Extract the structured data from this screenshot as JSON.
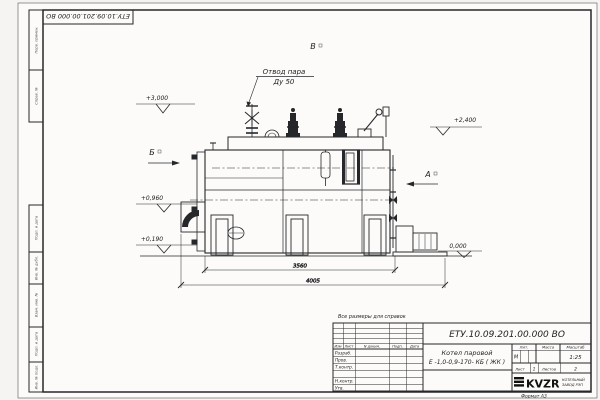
{
  "sheet": {
    "corner_stamp": "ЕТУ.10.09.201.00.000  ВО",
    "format_label": "Формат  А3",
    "note": "Все размеры для справок",
    "margin_labels": [
      "Перв. примен.",
      "Справ. №",
      "Подп. и дата",
      "Инв. № дубл.",
      "Взам. инв. №",
      "Подп. и дата",
      "Инв. № подл."
    ]
  },
  "drawing": {
    "callout": {
      "line1": "Отвод пара",
      "line2": "Ду 50"
    },
    "elevations": {
      "e3000": "+3,000",
      "e2400": "+2,400",
      "e0960": "+0,960",
      "e0190": "+0,190",
      "e0000": "0,000"
    },
    "views": {
      "b": "Б",
      "a": "А",
      "v": "В"
    },
    "dims": {
      "inner": "3560",
      "overall": "4005"
    }
  },
  "tb": {
    "doc_number": "ЕТУ.10.09.201.00.000  ВО",
    "cols": {
      "izm": "Изм",
      "list": "Лист",
      "doc": "N докум.",
      "sign": "Подп.",
      "date": "Дата"
    },
    "rows": {
      "r0": "Разраб.",
      "r1": "Пров.",
      "r2": "Т.контр.",
      "r3": "Н.контр.",
      "r4": "Утв."
    },
    "name": {
      "line1": "Котел паровой",
      "line2": "Е -1,0-0,9-170- КБ ( ЖК )"
    },
    "lit": {
      "label": "Лит.",
      "value": "М"
    },
    "mass": {
      "label": "Масса"
    },
    "scale": {
      "label": "Масштаб",
      "value": "1:25"
    },
    "sheet": {
      "label": "Лист",
      "value": "1"
    },
    "sheets": {
      "label": "Листов",
      "value": "2"
    },
    "logo": {
      "text": "KVZR",
      "cap1": "КОТЕЛЬНЫЙ",
      "cap2": "ЗАВОД РЭП"
    }
  },
  "colors": {
    "paper": "#fcfbf9",
    "ink": "#26272a"
  }
}
